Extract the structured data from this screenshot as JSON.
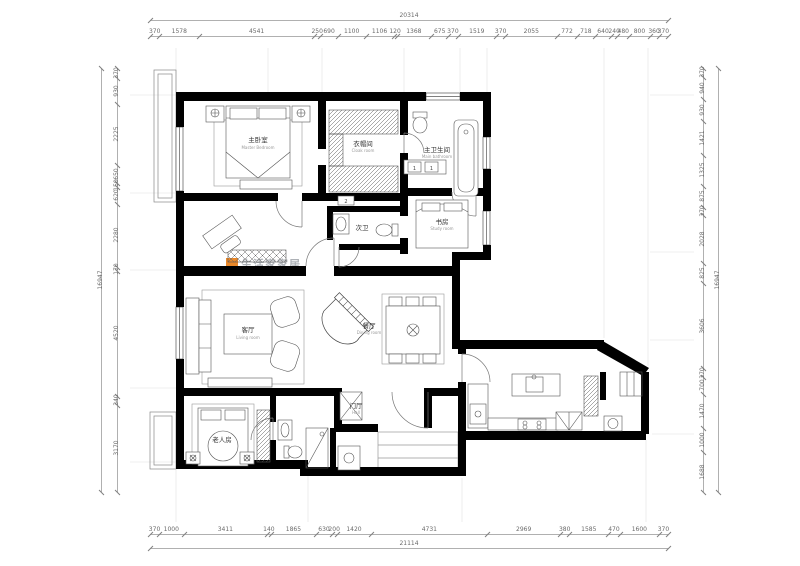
{
  "watermark": {
    "text": "生活家家居",
    "logo": "orange-square",
    "accent_color": "#e8821e"
  },
  "rooms": {
    "master": {
      "zh": "主卧室",
      "en": "Master Bedroom"
    },
    "cloak": {
      "zh": "衣帽间",
      "en": "Cloak room"
    },
    "main_bath": {
      "zh": "主卫生间",
      "en": "Main bathroom"
    },
    "study": {
      "zh": "书房",
      "en": "Study room"
    },
    "guest_bath": {
      "zh": "次卫"
    },
    "living": {
      "zh": "客厅",
      "en": "Living room"
    },
    "dining": {
      "zh": "餐厅",
      "en": "Dining room"
    },
    "hall": {
      "zh": "门厅",
      "en": "Hall"
    },
    "elder": {
      "zh": "老人房"
    }
  },
  "tags": {
    "vanity_left": "1",
    "vanity_right": "1",
    "corridor": "2"
  },
  "dimensions": {
    "top": {
      "total": 20314,
      "segments": [
        370,
        1578,
        4541,
        250,
        690,
        1100,
        1106,
        120,
        1368,
        675,
        370,
        1519,
        370,
        2055,
        772,
        718,
        640,
        240,
        480,
        800,
        360,
        370
      ]
    },
    "bottom": {
      "total": 21114,
      "segments": [
        370,
        1000,
        3411,
        140,
        1865,
        630,
        200,
        1420,
        4731,
        2969,
        380,
        1585,
        470,
        1600,
        370
      ]
    },
    "left": {
      "total": 16947,
      "segments": [
        370,
        930,
        2225,
        650,
        150,
        620,
        2280,
        170,
        4520,
        340,
        3170
      ]
    },
    "right": {
      "total": 16947,
      "segments": [
        370,
        940,
        930,
        1421,
        1325,
        875,
        370,
        2028,
        825,
        3606,
        370,
        700,
        1470,
        1000,
        1688
      ]
    }
  }
}
